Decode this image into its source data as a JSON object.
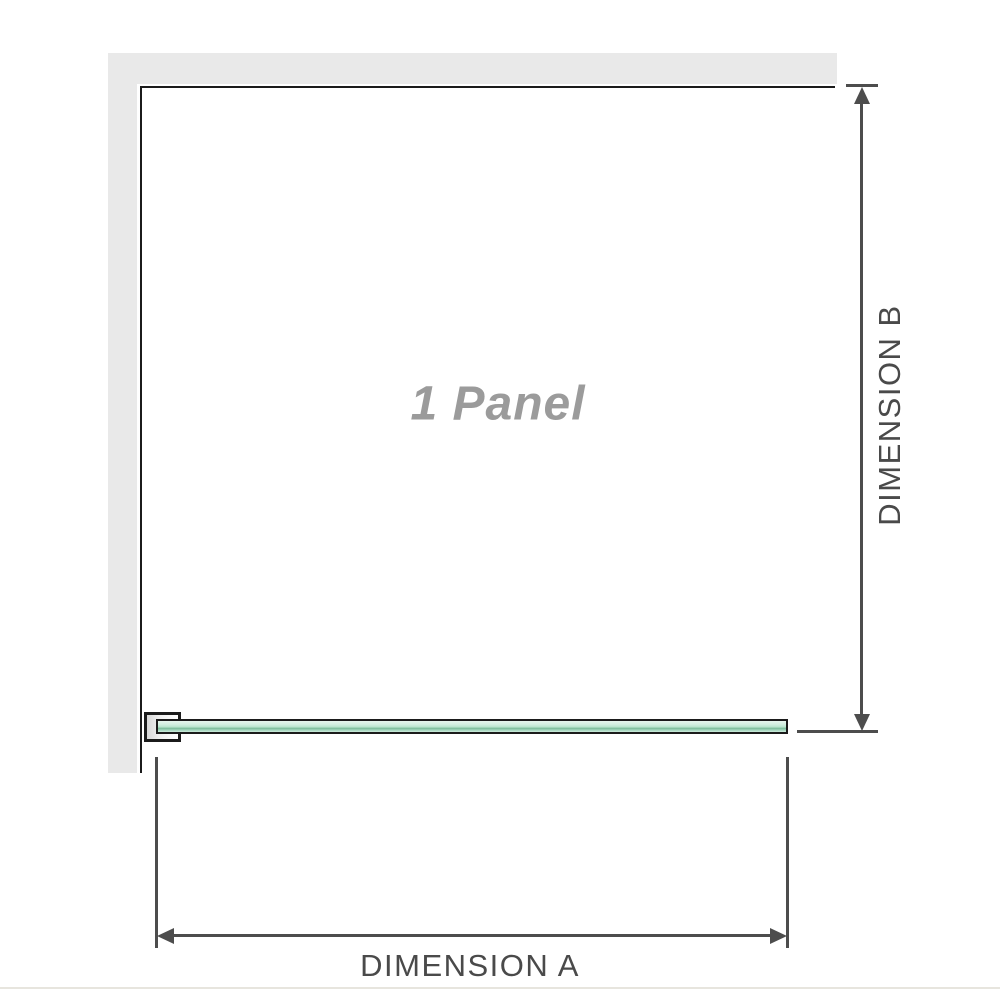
{
  "diagram": {
    "panel_label": "1 Panel",
    "dimension_a_label": "DIMENSION A",
    "dimension_b_label": "DIMENSION B"
  },
  "colors": {
    "wall_fill": "#e9e9e9",
    "line_dark": "#1b1b1b",
    "dim_color": "#4d4d4d",
    "dim_text": "#4a4a4a",
    "muted_label": "#9b9b9b",
    "glass_light": "#e8f6ee",
    "glass_mid": "#cdecdc",
    "glass_dark": "#7cbd9b",
    "divider": "#e7e5de"
  }
}
